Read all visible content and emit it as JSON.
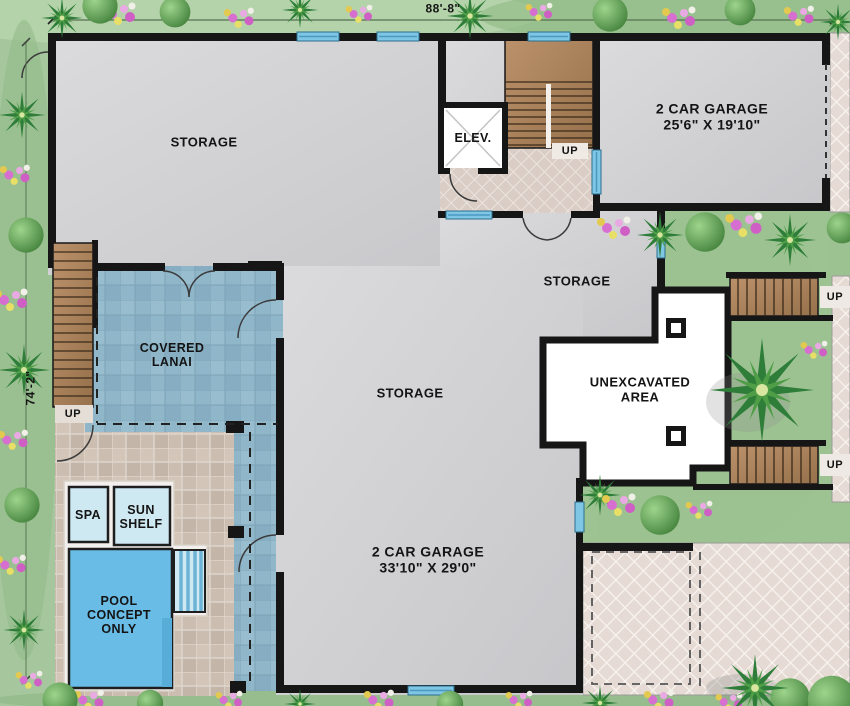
{
  "plan": {
    "dimension_top": "88'-8\"",
    "dimension_left": "74'-2\"",
    "rooms": {
      "storage_nw": "STORAGE",
      "elevator": "ELEV.",
      "garage_ne": "2 CAR GARAGE\n25'6\" X 19'10\"",
      "storage_mid": "STORAGE",
      "storage_center": "STORAGE",
      "covered_lanai": "COVERED\nLANAI",
      "unexcavated": "UNEXCAVATED\nAREA",
      "garage_s": "2 CAR GARAGE\n33'10\" X 29'0\"",
      "spa": "SPA",
      "sun_shelf": "SUN\nSHELF",
      "pool": "POOL\nCONCEPT\nONLY"
    },
    "stair_labels": {
      "stairwell": "UP",
      "left": "UP",
      "right_upper": "UP",
      "right_lower": "UP"
    },
    "colors": {
      "wall": "#161616",
      "floor_gray": "#d3d3d5",
      "lanai_blue": "#8fb6c9",
      "pool_blue": "#68bce6",
      "spa_blue": "#cfe9f2",
      "wood": "#ad8258",
      "driveway_tile": "#e6dbd4",
      "deck_stone": "#cbbdb0",
      "grass": "#a6c79d",
      "window_blue": "#7fc6e4",
      "unexcavated_white": "#ffffff"
    }
  }
}
